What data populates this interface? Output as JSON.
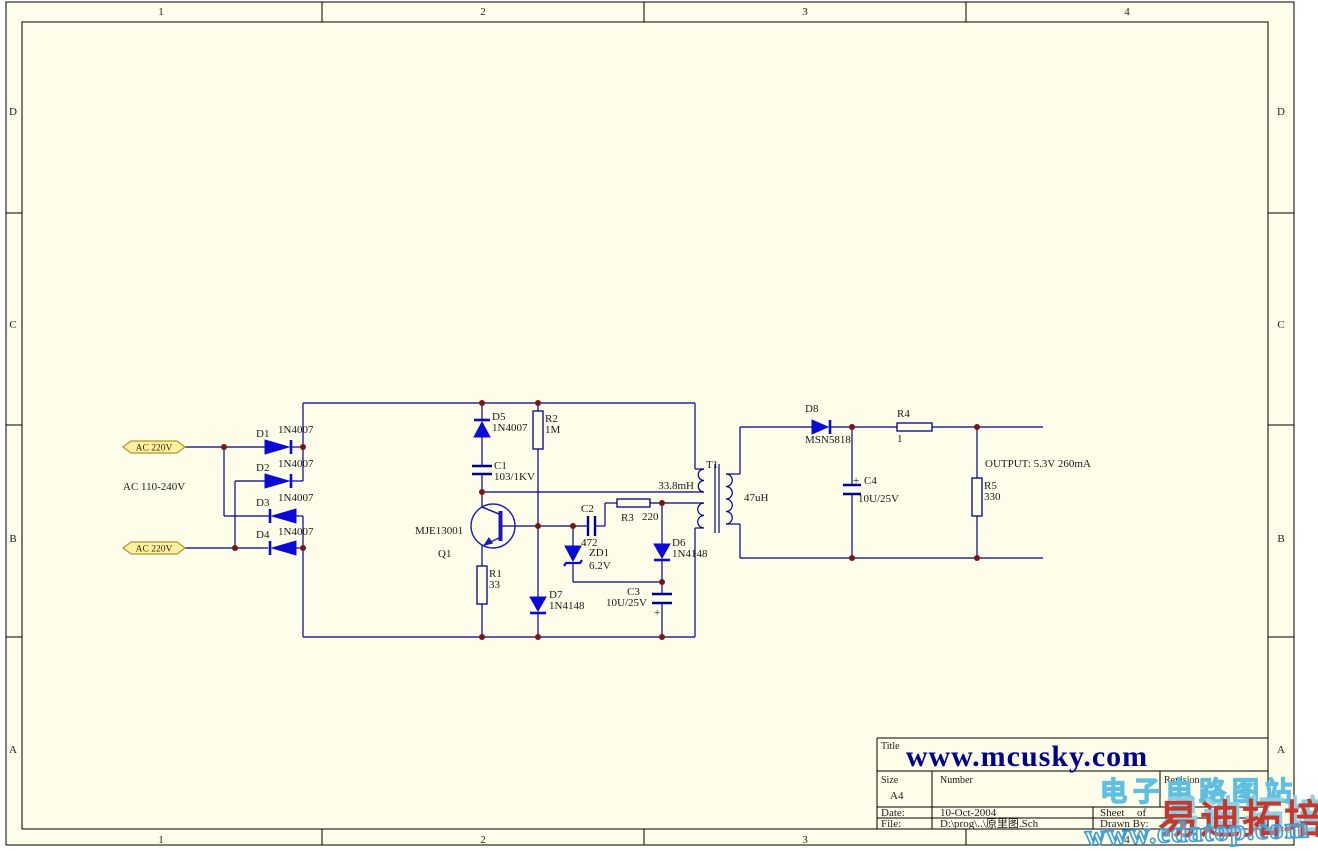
{
  "frame": {
    "columns": [
      "1",
      "2",
      "3",
      "4"
    ],
    "rows": [
      "D",
      "C",
      "B",
      "A"
    ]
  },
  "title_block": {
    "title_label": "Title",
    "title": "www.mcusky.com",
    "size_label": "Size",
    "size_value": "A4",
    "number_label": "Number",
    "revision_label": "Revision",
    "date_label": "Date:",
    "date_value": "10-Oct-2004",
    "sheet_label": "Sheet",
    "of_label": "of",
    "file_label": "File:",
    "file_value": "D:\\prog\\..\\原里图.Sch",
    "drawn_by_label": "Drawn By:"
  },
  "ports": {
    "ac_in_top": "AC 220V",
    "ac_in_bottom": "AC 220V",
    "ac_range_note": "AC 110-240V"
  },
  "output_note": "OUTPUT: 5.3V 260mA",
  "components": {
    "d1": {
      "ref": "D1",
      "value": "1N4007"
    },
    "d2": {
      "ref": "D2",
      "value": "1N4007"
    },
    "d3": {
      "ref": "D3",
      "value": "1N4007"
    },
    "d4": {
      "ref": "D4",
      "value": "1N4007"
    },
    "d5": {
      "ref": "D5",
      "value": "1N4007"
    },
    "d6": {
      "ref": "D6",
      "value": "1N4148"
    },
    "d7": {
      "ref": "D7",
      "value": "1N4148"
    },
    "d8": {
      "ref": "D8",
      "value": "MSN5818"
    },
    "zd1": {
      "ref": "ZD1",
      "value": "6.2V"
    },
    "q1": {
      "ref": "Q1",
      "value": "MJE13001"
    },
    "r1": {
      "ref": "R1",
      "value": "33"
    },
    "r2": {
      "ref": "R2",
      "value": "1M"
    },
    "r3": {
      "ref": "R3",
      "value": "220"
    },
    "r4": {
      "ref": "R4",
      "value": "1"
    },
    "r5": {
      "ref": "R5",
      "value": "330"
    },
    "c1": {
      "ref": "C1",
      "value": "103/1KV"
    },
    "c2": {
      "ref": "C2",
      "value": "472"
    },
    "c3": {
      "ref": "C3",
      "value": "10U/25V",
      "polarity": "+"
    },
    "c4": {
      "ref": "C4",
      "value": "10U/25V",
      "polarity": "+"
    },
    "t1": {
      "ref": "T1",
      "primary_value": "33.8mH",
      "secondary_value": "47uH"
    }
  },
  "watermarks": {
    "site_name_cn": "电子电路图站",
    "training_cn": "易迪拓培训",
    "site_url": "www.edatop.com",
    "site_url_small": "www.edatop.com"
  },
  "colors": {
    "sheet_bg": "#FDFDE9",
    "wire_blue": "#000090",
    "symbol_blue": "#0B0BD8",
    "junction_dot": "#7A1515",
    "port_fill": "#FFF0A0",
    "port_border": "#AD9530",
    "title_blue": "#00008B",
    "watermark_cyan": "#5FBFE0",
    "watermark_red": "#C5382B"
  }
}
